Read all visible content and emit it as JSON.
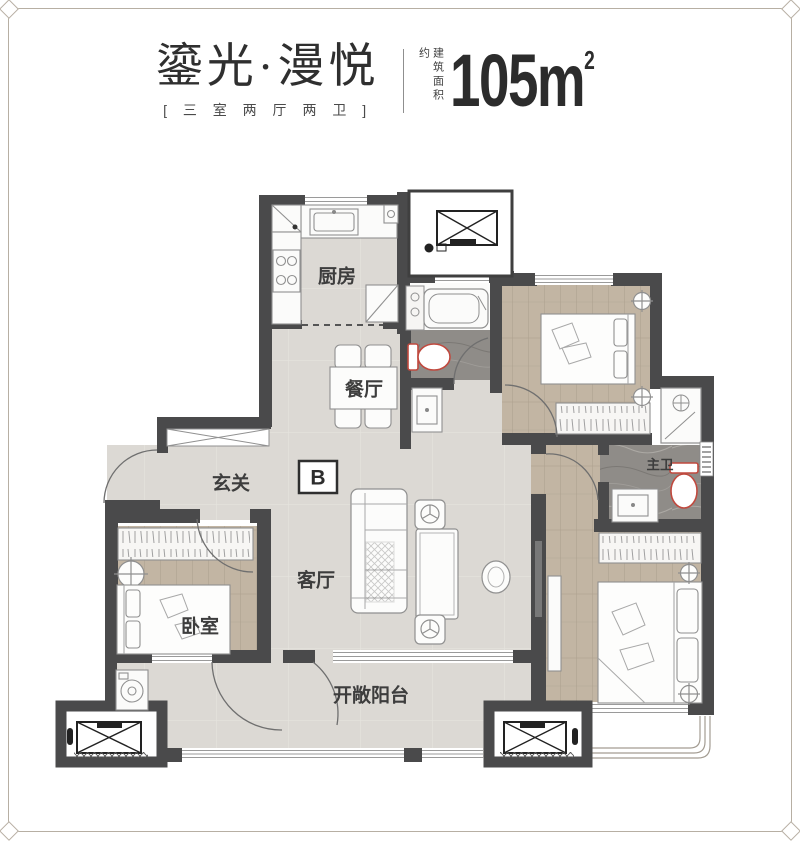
{
  "header": {
    "title": "鎏光·漫悦",
    "subtitle": "[ 三 室 两 厅 两 卫 ]",
    "area_label": "建筑面积约",
    "area_value": "105m",
    "area_superscript": "2"
  },
  "plan": {
    "unit_label": "B",
    "rooms": {
      "kitchen": "厨房",
      "dining": "餐厅",
      "foyer": "玄关",
      "living": "客厅",
      "bedroom": "卧室",
      "master_bath": "主卫",
      "balcony": "开敞阳台"
    },
    "colors": {
      "wall": "#4a4a4b",
      "floor_light": "#dcd9d4",
      "floor_wood": "#c2b5a3",
      "floor_marble": "#8f8c88",
      "toilet_red": "#c0493e",
      "frame": "#b7afa3",
      "text": "#3d3d3d"
    }
  }
}
